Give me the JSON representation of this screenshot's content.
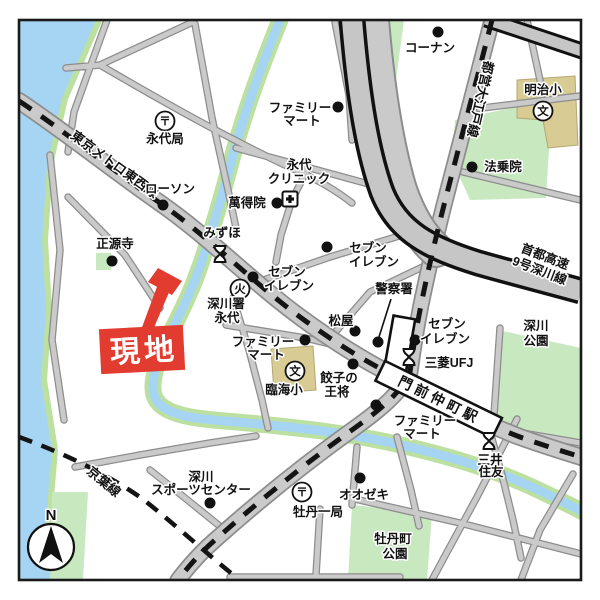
{
  "rails": {
    "tozai": "東京メトロ東西線",
    "oedo": "都営大江戸線",
    "keiyo": "京葉線",
    "shuto_1": "首都高速",
    "shuto_2": "9号深川線"
  },
  "station": {
    "name": "門前仲町駅"
  },
  "marker": {
    "label": "現地"
  },
  "compass": {
    "north": "N"
  },
  "symbols": {
    "post": "〒",
    "school": "文",
    "fire": "火"
  },
  "pois": {
    "eitai_post": {
      "name": "永代局"
    },
    "lawson": {
      "name": "ローソン"
    },
    "famima_top": {
      "l1": "ファミリー",
      "l2": "マート"
    },
    "kohnan": {
      "name": "コーナン"
    },
    "meiji_elem": {
      "name": "明治小"
    },
    "hojoin": {
      "name": "法乗院"
    },
    "eitai_clinic": {
      "l1": "永代",
      "l2": "クリニック"
    },
    "mantokuin": {
      "name": "萬得院"
    },
    "mizuho": {
      "name": "みずほ"
    },
    "shogenji": {
      "name": "正源寺"
    },
    "seven_a": {
      "l1": "セブン",
      "l2": "イレブン"
    },
    "seven_b": {
      "l1": "セブン",
      "l2": "イレブン"
    },
    "seven_c": {
      "l1": "セブン",
      "l2": "イレブン"
    },
    "fire_eitai": {
      "l1": "深川署",
      "l2": "永代"
    },
    "police": {
      "name": "警察署"
    },
    "matsuya": {
      "name": "松屋"
    },
    "famima_mid": {
      "l1": "ファミリー",
      "l2": "マート"
    },
    "rinkai_elem": {
      "name": "臨海小"
    },
    "gyoza": {
      "l1": "餃子の",
      "l2": "王将"
    },
    "ufj": {
      "name": "三菱UFJ"
    },
    "famima_st": {
      "l1": "ファミリー",
      "l2": "マート"
    },
    "smbc": {
      "l1": "三井",
      "l2": "住友"
    },
    "fukagawa_park": {
      "l1": "深川",
      "l2": "公園"
    },
    "ozeki": {
      "name": "オオゼキ"
    },
    "botan_post": {
      "name": "牡丹一局"
    },
    "botancho_park": {
      "l1": "牡丹町",
      "l2": "公園"
    },
    "sports": {
      "l1": "深川",
      "l2": "スポーツセンター"
    }
  },
  "colors": {
    "water": "#A5D5F2",
    "bank": "#BCE0A0",
    "park": "#C8E8C0",
    "road": "#CACACA",
    "casing": "#8D8D8D",
    "bldg": "#D8CB93",
    "red": "#E23B2F"
  }
}
